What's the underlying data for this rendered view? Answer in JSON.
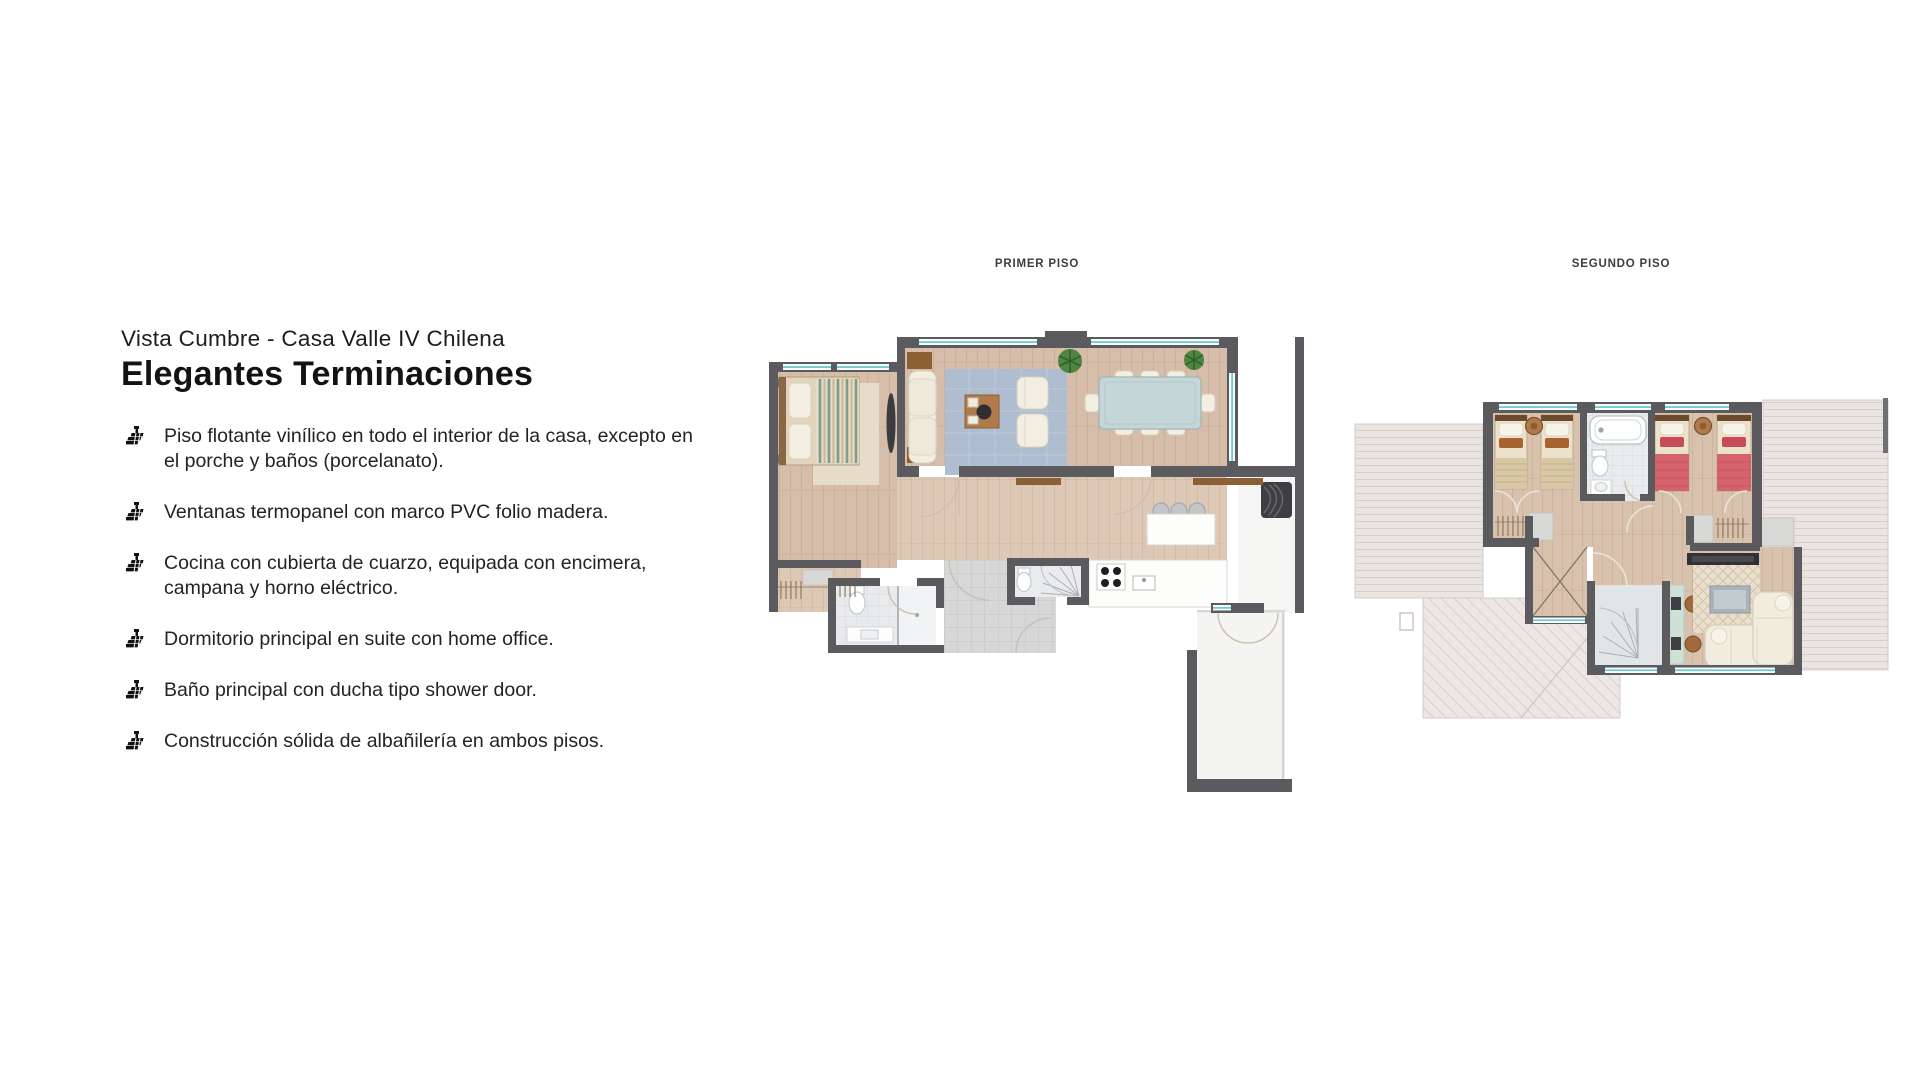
{
  "page": {
    "subtitle": "Vista Cumbre - Casa Valle IV Chilena",
    "title": "Elegantes Terminaciones"
  },
  "features": {
    "bullet_icon": "brick-floor-icon",
    "items": [
      {
        "text": "Piso flotante vinílico en todo el interior de la casa, excepto en el porche y baños (porcelanato)."
      },
      {
        "text": "Ventanas termopanel con marco PVC folio madera."
      },
      {
        "text": "Cocina con cubierta de cuarzo, equipada con encimera, campana y horno eléctrico."
      },
      {
        "text": "Dormitorio principal en suite con home office."
      },
      {
        "text": "Baño principal con ducha tipo shower door."
      },
      {
        "text": "Construcción sólida de albañilería en ambos pisos."
      }
    ]
  },
  "floor_plans": {
    "first": {
      "label": "PRIMER PISO"
    },
    "second": {
      "label": "SEGUNDO PISO"
    }
  },
  "colors": {
    "wall": "#5b5b5f",
    "wood": "#d5bda9",
    "plank": "#c3a68f",
    "wood_light": "#dcc8b5",
    "tile": "#d7d7d7",
    "tileline": "#c3c3c3",
    "bath": "#e8eaeb",
    "bathline": "#d3d7d9",
    "roof": "#ebe5e2",
    "roofline": "#d7cecb",
    "window": "#6fc9ce",
    "rug_blue": "#aebdcf",
    "bed_red": "#d6626c",
    "plant": "#4e8540",
    "text_dark": "#1d1d1f",
    "label_gray": "#3d3d40"
  }
}
